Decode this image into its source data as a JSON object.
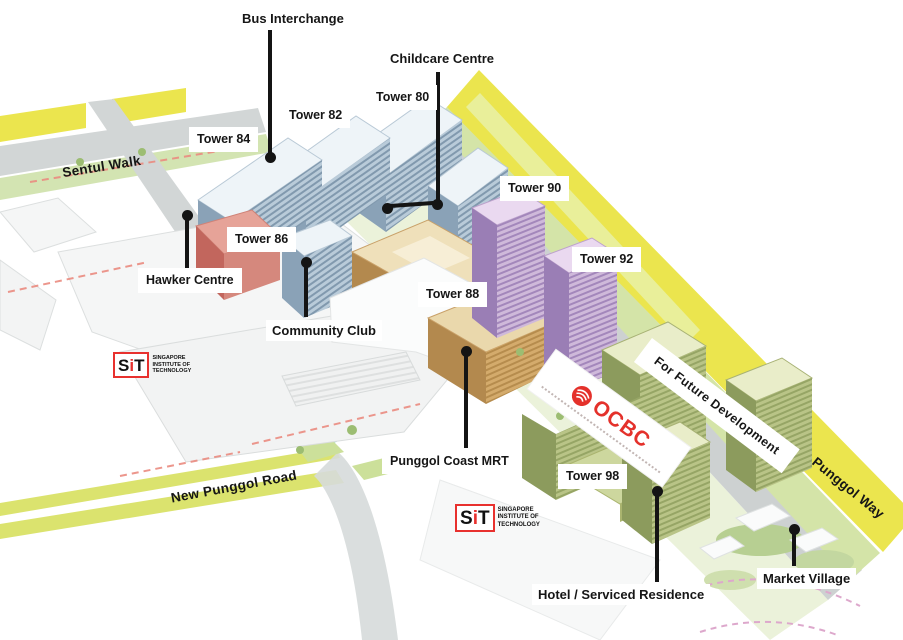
{
  "labels": {
    "towers": [
      "Tower 80",
      "Tower 82",
      "Tower 84",
      "Tower 86",
      "Tower 88",
      "Tower 90",
      "Tower 92",
      "Tower 98"
    ],
    "bus_interchange": "Bus Interchange",
    "childcare_centre": "Childcare Centre",
    "hawker_centre": "Hawker Centre",
    "community_club": "Community Club",
    "punggol_coast_mrt": "Punggol Coast MRT",
    "hotel_serviced_residence": "Hotel / Serviced Residence",
    "market_village": "Market Village",
    "future_development": "For Future Development"
  },
  "roads": {
    "sentul_walk": "Sentul Walk",
    "new_punggol_road": "New Punggol Road",
    "punggol_way": "Punggol Way"
  },
  "logos": {
    "sit": {
      "letter_s": "S",
      "letter_i": "i",
      "letter_t": "T",
      "line1": "SINGAPORE",
      "line2": "INSTITUTE OF",
      "line3": "TECHNOLOGY"
    },
    "ocbc": {
      "wordmark": "OCBC"
    }
  },
  "colors": {
    "tower_blue": "#9db3c6",
    "tower_purple": "#b79ac7",
    "tower_tan": "#cfa76e",
    "tower_olive": "#a7b573",
    "hawker_red": "#cd7a70",
    "road_yellow": "#ebe54e",
    "ocbc_red": "#e4312b",
    "sit_red": "#e8312e"
  }
}
